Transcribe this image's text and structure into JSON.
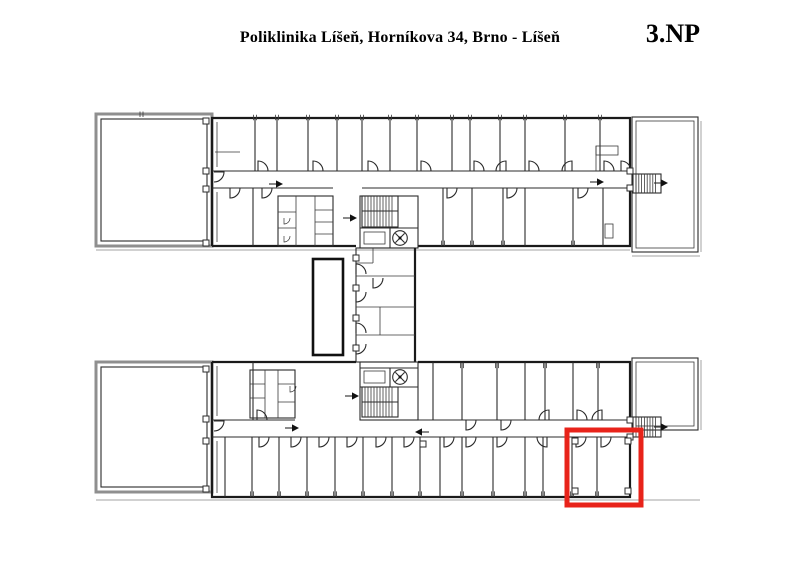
{
  "header": {
    "title": "Poliklinika Líšeň, Horníkova 34, Brno - Líšeň",
    "floor_label": "3.NP"
  },
  "plan": {
    "highlight": {
      "x": 567,
      "y": 430,
      "w": 74,
      "h": 75,
      "color": "#E8231A",
      "stroke_width": 5
    },
    "colors": {
      "wall": "#2B2B2B",
      "heavy_wall": "#161616",
      "terrace_outline": "#8F8F8F",
      "shadow": "#C2C2C2",
      "background": "#FFFFFF",
      "highlight": "#E8231A"
    },
    "icons": {
      "stairs-icon": "hatched rectangle",
      "elevator-fan-icon": "circle with cross blades",
      "door-arc-icon": "quarter-circle arc",
      "direction-arrow-icon": "→",
      "window-tick-icon": "double tick on wall",
      "column-post-icon": "small hollow square"
    }
  }
}
